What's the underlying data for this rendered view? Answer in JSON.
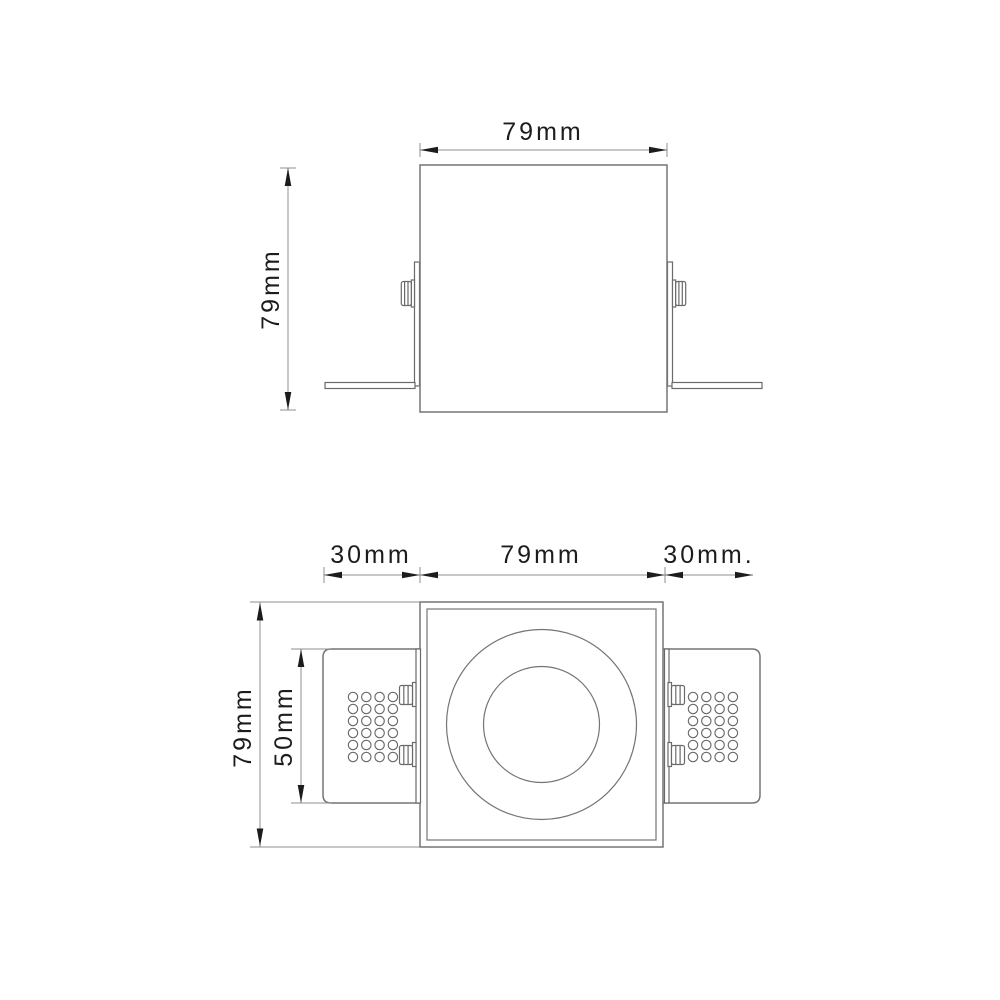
{
  "drawing": {
    "background": "#ffffff",
    "line_color": "#757575",
    "dimension_line_color": "#8f8f8f",
    "text_color": "#1c1c1c"
  },
  "front_view": {
    "width_label": "79mm",
    "height_label": "79mm"
  },
  "plan_view": {
    "left_wing_label": "30mm",
    "body_label": "79mm",
    "right_wing_label": "30mm.",
    "height_label": "79mm",
    "wing_height_label": "50mm",
    "hole_grid": {
      "rows": 6,
      "cols": 4
    }
  }
}
